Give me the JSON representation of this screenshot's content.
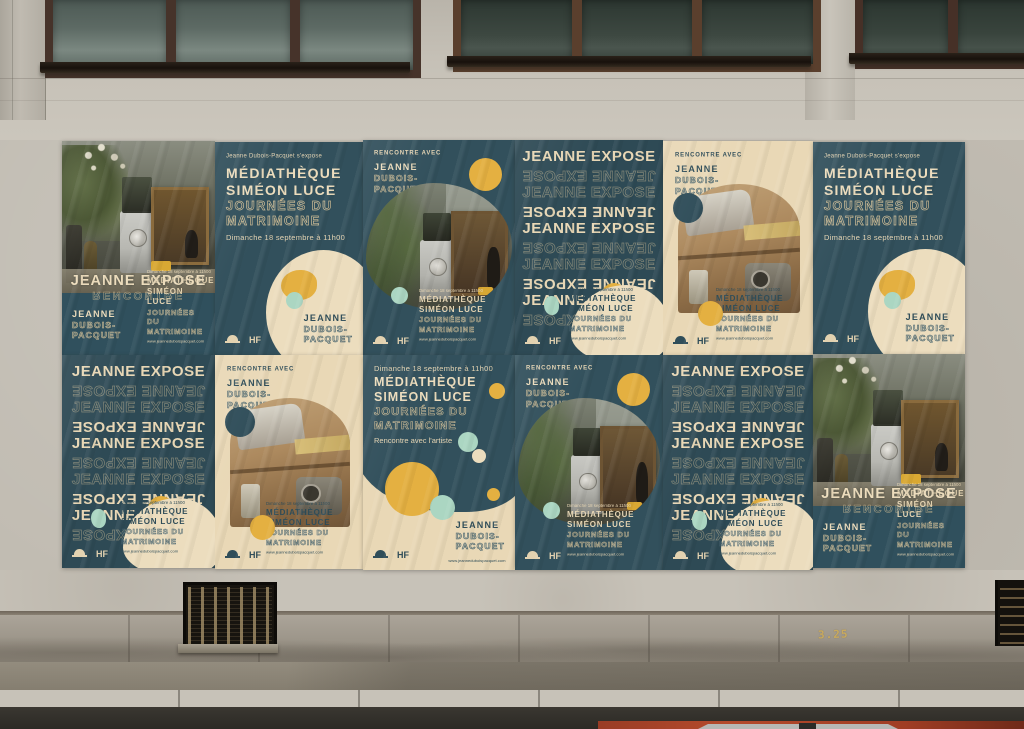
{
  "poster": {
    "title": "JEANNE EXPOSE",
    "title_mirror": "RENCONTRE",
    "tagline": "Jeanne Dubois-Pacquet s'expose",
    "meet": "RENCONTRE AVEC",
    "meet_artist": "Rencontre avec l'artiste",
    "artist": {
      "first": "JEANNE",
      "last1": "DUBOIS-",
      "last2": "PACQUET"
    },
    "venue_line1": "MÉDIATHÈQUE",
    "venue_line2": "SIMÉON LUCE",
    "event_line1": "JOURNÉES DU",
    "event_line2": "MATRIMOINE",
    "date": "Dimanche 18 septembre à 11h00",
    "website": "www.jeanneduboispacquet.com",
    "logo_hf": "HF"
  },
  "wall": {
    "marking": "3.25"
  },
  "colors": {
    "teal": "#32505C",
    "cream": "#E9D8B6",
    "yellow": "#E4B041",
    "mint": "#ABD6C2"
  }
}
